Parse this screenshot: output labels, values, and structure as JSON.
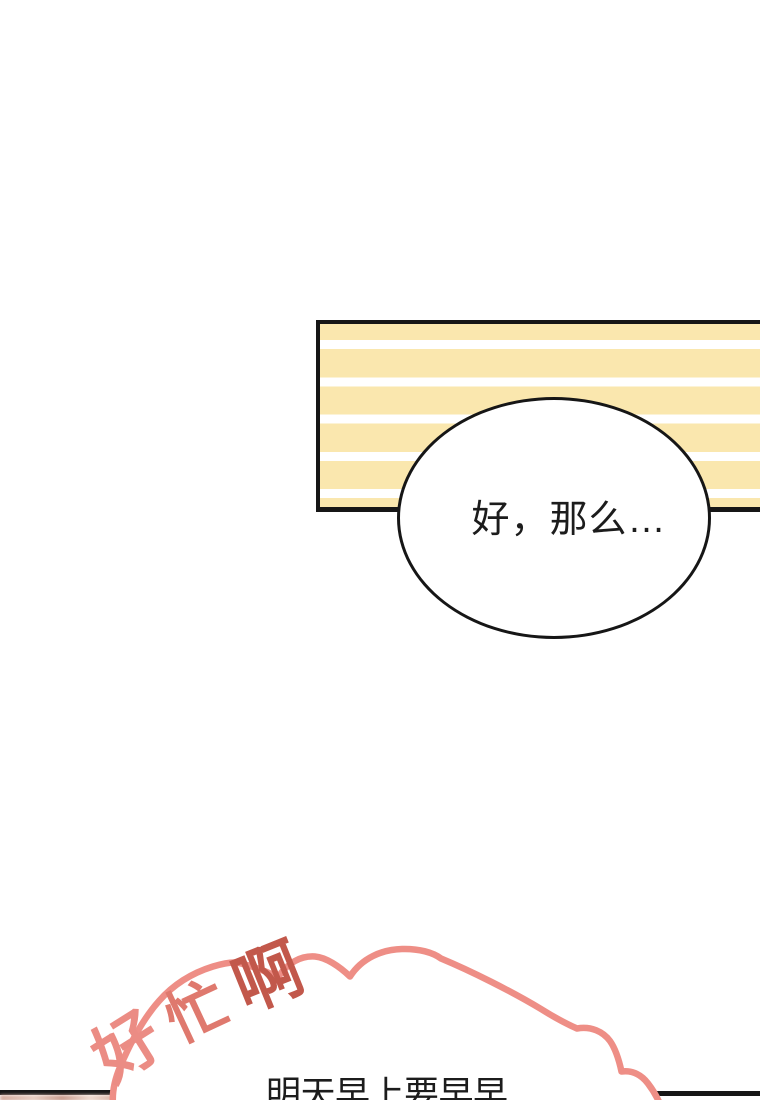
{
  "colors": {
    "board_yellow": "#FAE7AE",
    "outline_black": "#161616",
    "cloud_pink": "#EE8E86",
    "text_dark": "#1C1C1C"
  },
  "speech_bubble": {
    "text": "好，那么…"
  },
  "cloud_bubble": {
    "partial_text": "明天早上要早早",
    "exclamation": {
      "text": "好忙啊",
      "chars": [
        {
          "ch": "好",
          "color": "#EB8C84"
        },
        {
          "ch": "忙",
          "color": "#DF796E"
        },
        {
          "ch": "啊",
          "color": "#C2584B"
        }
      ]
    }
  }
}
